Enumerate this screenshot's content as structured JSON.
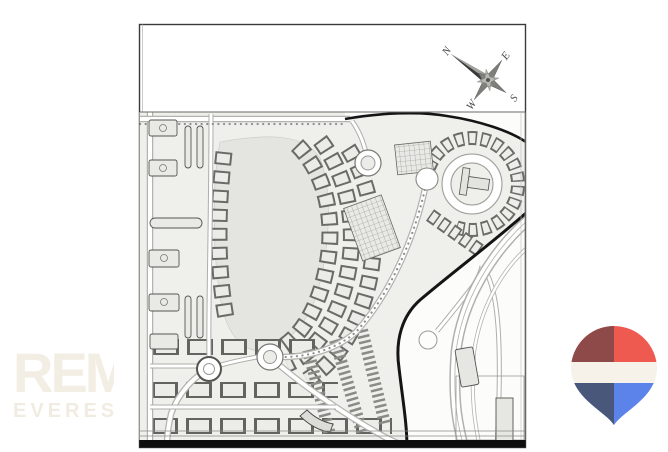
{
  "page": {
    "background": "#ffffff",
    "description": "Real-estate listing photo: black-and-white master plan drawing with compass rose, agency watermark and RE/MAX balloon logo"
  },
  "watermark": {
    "line1": "REM",
    "line2": "EVEREST",
    "color": "#f3eee4"
  },
  "site_plan": {
    "frame_color": "#3a3a3a",
    "boundary_color": "#151515",
    "compass": {
      "n": "N",
      "e": "E",
      "s": "S",
      "w": "W"
    }
  },
  "logo": {
    "colors": {
      "red": "#ef5a50",
      "red_dark": "#8e4949",
      "white": "#f6f2ea",
      "blue": "#5b83ea",
      "blue_dark": "#49587a"
    }
  }
}
